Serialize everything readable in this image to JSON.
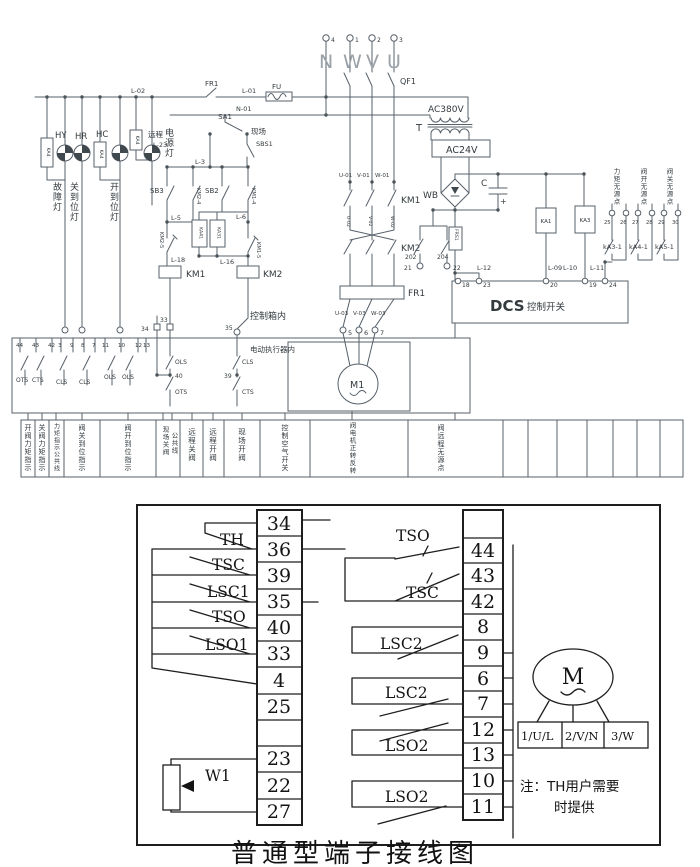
{
  "title": "普通型端子接线图",
  "top": {
    "supply": {
      "t4": "4",
      "t1": "1",
      "t2": "2",
      "t3": "3",
      "n": "N",
      "w": "W",
      "v": "V",
      "u": "U",
      "qf1": "QF1",
      "fr1": "FR1",
      "l01": "L-01",
      "fu": "FU",
      "l02": "L-02",
      "n01": "N-01"
    },
    "sa": {
      "sa1": "SA1",
      "remote": "远程",
      "l23": "L-23",
      "local": "现场",
      "sbs1": "SBS1"
    },
    "lamps": {
      "hy": "HY",
      "hr": "HR",
      "hc": "HC",
      "ka4a": "KA4",
      "ka4b": "KA4",
      "ka4c": "KA4",
      "power": "电源灯",
      "fault": "故障灯",
      "closed": "关到位灯",
      "opened": "开到位灯"
    },
    "ctrl": {
      "l3": "L-3",
      "sb3": "SB3",
      "km2_4": "KM2-4",
      "sb2": "SB2",
      "km1_4": "KM1-4",
      "l5": "L-5",
      "l6": "L-6",
      "ka41": "KA41",
      "ka31": "KA31",
      "km2_5": "KM2-5",
      "km1_5": "KM1-5",
      "l18": "L-18",
      "l16": "L-16",
      "km1": "KM1",
      "km2": "KM2",
      "box": "控制箱内",
      "t34": "34",
      "t33": "33",
      "t35": "35"
    },
    "main": {
      "u01": "U-01",
      "v01": "V-01",
      "w01": "W-01",
      "km1": "KM1",
      "u02": "U-02",
      "v02": "V-02",
      "w02": "W-02",
      "km2": "KM2",
      "fr1": "FR1",
      "u03": "U-03",
      "v03": "V-03",
      "w03": "W-03",
      "t5": "5",
      "t6": "6",
      "t7": "7"
    },
    "psu": {
      "ac380": "AC380V",
      "t": "T",
      "ac24": "AC24V",
      "wb": "WB",
      "c": "C",
      "plus": "+",
      "frs1": "FRS1",
      "c202": "202",
      "c204": "204",
      "t21": "21",
      "t22": "22",
      "l12": "L-12",
      "t18": "18",
      "t23": "23",
      "dcs": "DCS",
      "dcs_sw": "控制开关",
      "ka1": "KA1",
      "ka3": "KA3",
      "l09": "L-09",
      "l10": "L-10",
      "l11": "L-11",
      "t20": "20",
      "t19": "19",
      "t24": "24"
    },
    "passive": {
      "torque": "力矩无源点",
      "open": "阀开无源点",
      "close": "阀关无源点",
      "t25": "25",
      "t26": "26",
      "t27": "27",
      "t28": "28",
      "t29": "29",
      "t30": "30",
      "ka3_1": "kA3-1",
      "ka4_1": "kA4-1",
      "ka5_1": "kA5-1"
    },
    "act": {
      "label": "电动执行器内",
      "m1": "M1",
      "nums": [
        "44",
        "43",
        "42",
        "3",
        "9",
        "8",
        "7",
        "11",
        "10",
        "12",
        "13"
      ],
      "sw": [
        "OTS",
        "CTS",
        "CLS",
        "CLS",
        "OLS",
        "OLS"
      ],
      "g1": [
        "OLS",
        "40",
        "OTS"
      ],
      "g2": [
        "CLS",
        "39",
        "CTS"
      ]
    },
    "rows": [
      "开阀力矩指示",
      "关阀力矩指示",
      "力矩指示公共线",
      "阀关到位指示",
      "阀开到位指示",
      "现场关阀",
      "公共线",
      "远程关阀",
      "远程开阀",
      "现场开阀",
      "控制空气开关",
      "阀电机正转反转",
      "阀远程无源点"
    ]
  },
  "bottom": {
    "left": [
      "34",
      "36",
      "39",
      "35",
      "40",
      "33",
      "4",
      "25",
      "",
      "23",
      "22",
      "27"
    ],
    "right": [
      "",
      "44",
      "43",
      "42",
      "8",
      "9",
      "6",
      "7",
      "12",
      "13",
      "10",
      "11"
    ],
    "lsw": {
      "th": "TH",
      "tsc": "TSC",
      "lsc1": "LSC1",
      "tso": "TSO",
      "lso1": "LSO1",
      "w1": "W1"
    },
    "rsw": {
      "tso": "TSO",
      "tsc": "TSC",
      "lsc2a": "LSC2",
      "lsc2b": "LSC2",
      "lso2a": "LSO2",
      "lso2b": "LSO2"
    },
    "motor": {
      "m": "M",
      "t1": "1/U/L",
      "t2": "2/V/N",
      "t3": "3/W"
    },
    "note1": "注：TH用户需要",
    "note2": "时提供"
  }
}
